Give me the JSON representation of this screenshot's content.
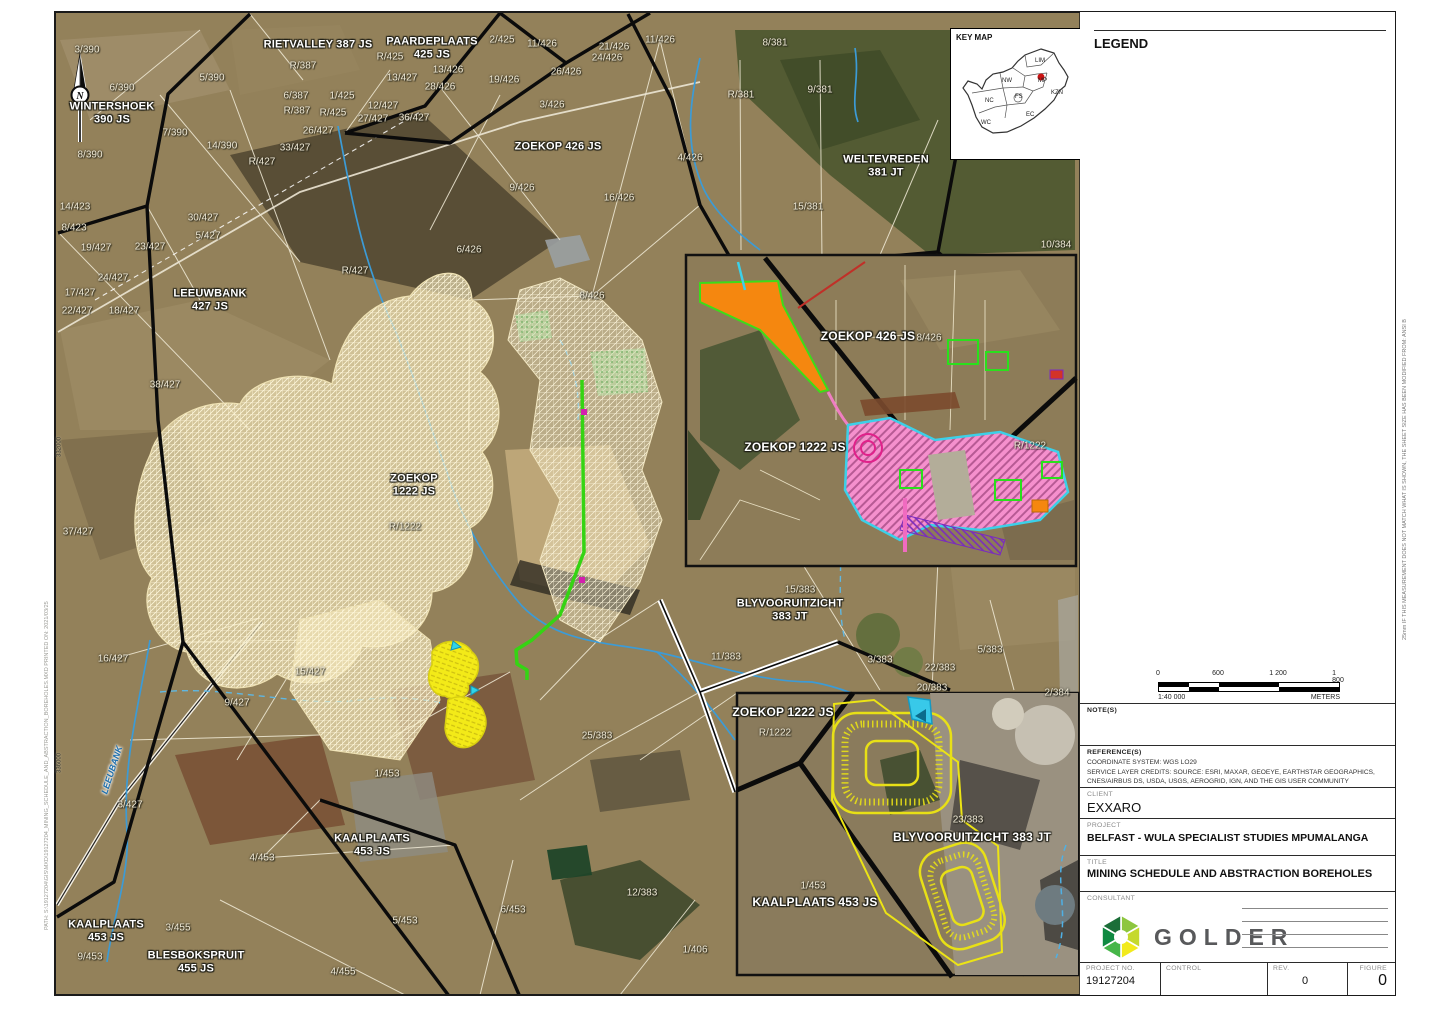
{
  "key_map": {
    "title": "KEY MAP",
    "provinces": [
      {
        "t": "LIM",
        "x": 80,
        "y": 19
      },
      {
        "t": "NW",
        "x": 47,
        "y": 39
      },
      {
        "t": "MP",
        "x": 83,
        "y": 39
      },
      {
        "t": "FS",
        "x": 60,
        "y": 55
      },
      {
        "t": "KZN",
        "x": 96,
        "y": 51
      },
      {
        "t": "NC",
        "x": 30,
        "y": 59
      },
      {
        "t": "EC",
        "x": 71,
        "y": 73
      },
      {
        "t": "WC",
        "x": 26,
        "y": 81
      }
    ],
    "marker_color": "#cc1111"
  },
  "legend": {
    "title": "LEGEND",
    "items": [
      {
        "label": "Conveyor Alternative D PCD's",
        "type": "line",
        "color": "#c4259f"
      },
      {
        "label": "Conveyor Alternative D",
        "type": "line",
        "color": "#76c043"
      },
      {
        "label": "Sumps",
        "type": "line-thin",
        "color": "#7fd4e4"
      },
      {
        "label": "BEP 2020 Infrastructure Area",
        "type": "fill",
        "color": "#f4f3ee",
        "border": "#e3e1d8"
      },
      {
        "label": "Discard Dump (Pit 5b)",
        "type": "line-thin",
        "color": "#efe9a0"
      },
      {
        "label": "BIP Opencast Schedule",
        "type": "fill",
        "color": "#fbf3d3",
        "border": "#e8dfba"
      },
      {
        "label": "BEP Opencast Schedule",
        "type": "fill",
        "color": "#fdf9e7",
        "border": "#ebe6cc"
      },
      {
        "label": "Parent Farms",
        "type": "rect-thick",
        "color": "#000000"
      },
      {
        "label": "Farm Portions",
        "type": "rect-thin",
        "color": "#cfcdc2"
      },
      {
        "label": "MiningRightsArea",
        "type": "rect-double",
        "color": "#000000"
      },
      {
        "label": "River perennial",
        "type": "line-thin",
        "color": "#2e9fd4"
      },
      {
        "label": "River non perennial",
        "type": "line-thin",
        "color": "#6cbde4"
      }
    ]
  },
  "scalebar": {
    "ticks": [
      "0",
      "600",
      "1 200",
      "1 800"
    ],
    "ratio": "1:40 000",
    "units": "METERS"
  },
  "titleblock": {
    "notes_label": "NOTE(S)",
    "references_label": "REFERENCE(S)",
    "reference_lines": [
      "COORDINATE SYSTEM: WGS LO29",
      "SERVICE LAYER CREDITS: SOURCE: ESRI, MAXAR, GEOEYE, EARTHSTAR GEOGRAPHICS,",
      "CNES/AIRBUS DS, USDA, USGS, AEROGRID, IGN, AND THE GIS USER COMMUNITY"
    ],
    "client_label": "CLIENT",
    "client": "EXXARO",
    "project_label": "PROJECT",
    "project": "BELFAST - WULA SPECIALIST STUDIES MPUMALANGA",
    "title_label": "TITLE",
    "title": "MINING SCHEDULE AND ABSTRACTION BOREHOLES",
    "consultant_label": "CONSULTANT",
    "consultant_logo": "GOLDER",
    "rows": [
      {
        "label": "YYYY-MM-DD",
        "value": "2021/03/25"
      },
      {
        "label": "DESIGNED",
        "value": "MB"
      },
      {
        "label": "PREPARED",
        "value": "MJ"
      },
      {
        "label": "REVIEWED",
        "value": "DM"
      },
      {
        "label": "APPROVED",
        "value": "DM"
      }
    ],
    "project_no_label": "PROJECT NO.",
    "project_no": "19127204",
    "control_label": "CONTROL",
    "control": "",
    "rev_label": "REV.",
    "rev": "0",
    "figure_label": "FIGURE",
    "figure": "0",
    "sheet_note": "25mm   IF THIS MEASUREMENT DOES NOT MATCH WHAT IS SHOWN, THE SHEET SIZE HAS BEEN MODIFIED FROM: ANSI B",
    "path_note": "PATH: S:\\19127204\\GIS\\MXD\\19127204_MINING_SCHEDULE_AND_ABSTRACTION_BOREHOLES.MXD   PRINTED ON: 2021/03/25"
  },
  "map": {
    "farm_labels": [
      [
        "WINTERSHOEK\n390 JS",
        112,
        113
      ],
      [
        "RIETVALLEY 387 JS",
        318,
        45
      ],
      [
        "PAARDEPLAATS\n425 JS",
        432,
        48
      ],
      [
        "ZOEKOP 426 JS",
        558,
        147
      ],
      [
        "WELTEVREDEN\n381 JT",
        886,
        166
      ],
      [
        "LEEUWBANK\n427 JS",
        210,
        300
      ],
      [
        "ZOEKOP\n1222 JS",
        414,
        485
      ],
      [
        "BLYVOORUITZICHT\n383 JT",
        790,
        610
      ],
      [
        "KAALPLAATS\n453 JS",
        372,
        845
      ],
      [
        "KAALPLAATS\n453 JS",
        106,
        931
      ],
      [
        "BLESBOKSPRUIT\n455 JS",
        196,
        962
      ]
    ],
    "inset_farm_labels": [
      [
        "ZOEKOP 426 JS",
        868,
        337
      ],
      [
        "ZOEKOP 1222 JS",
        795,
        448
      ],
      [
        "ZOEKOP 1222 JS",
        783,
        713
      ],
      [
        "BLYVOORUITZICHT 383 JT",
        972,
        838
      ],
      [
        "KAALPLAATS 453 JS",
        815,
        903
      ]
    ],
    "portion_labels": [
      [
        "3/390",
        87,
        50
      ],
      [
        "6/390",
        122,
        88
      ],
      [
        "5/390",
        212,
        78
      ],
      [
        "8/390",
        90,
        155
      ],
      [
        "7/390",
        175,
        133
      ],
      [
        "14/390",
        222,
        146
      ],
      [
        "R/387",
        303,
        66
      ],
      [
        "6/387",
        296,
        96
      ],
      [
        "R/387",
        297,
        111
      ],
      [
        "R/425",
        390,
        57
      ],
      [
        "R/425",
        333,
        113
      ],
      [
        "1/425",
        342,
        96
      ],
      [
        "13/427",
        402,
        78
      ],
      [
        "12/427",
        383,
        106
      ],
      [
        "26/427",
        318,
        131
      ],
      [
        "27/427",
        373,
        119
      ],
      [
        "36/427",
        414,
        118
      ],
      [
        "33/427",
        295,
        148
      ],
      [
        "R/427",
        262,
        162
      ],
      [
        "R/427",
        355,
        271
      ],
      [
        "14/423",
        75,
        207
      ],
      [
        "8/423",
        74,
        228
      ],
      [
        "19/427",
        96,
        248
      ],
      [
        "23/427",
        150,
        247
      ],
      [
        "30/427",
        203,
        218
      ],
      [
        "5/427",
        208,
        236
      ],
      [
        "24/427",
        113,
        278
      ],
      [
        "17/427",
        80,
        293
      ],
      [
        "22/427",
        77,
        311
      ],
      [
        "18/427",
        124,
        311
      ],
      [
        "38/427",
        165,
        385
      ],
      [
        "37/427",
        78,
        532
      ],
      [
        "16/427",
        113,
        659
      ],
      [
        "15/427",
        310,
        672
      ],
      [
        "9/427",
        237,
        703
      ],
      [
        "3/427",
        130,
        805
      ],
      [
        "2/425",
        502,
        40
      ],
      [
        "11/426",
        542,
        44
      ],
      [
        "21/426",
        614,
        47
      ],
      [
        "11/426",
        660,
        40
      ],
      [
        "24/426",
        607,
        58
      ],
      [
        "13/426",
        448,
        70
      ],
      [
        "26/426",
        566,
        72
      ],
      [
        "19/426",
        504,
        80
      ],
      [
        "28/426",
        440,
        87
      ],
      [
        "3/426",
        552,
        105
      ],
      [
        "4/426",
        690,
        158
      ],
      [
        "9/426",
        522,
        188
      ],
      [
        "16/426",
        619,
        198
      ],
      [
        "6/426",
        469,
        250
      ],
      [
        "8/426",
        592,
        296
      ],
      [
        "8/381",
        775,
        43
      ],
      [
        "R/381",
        741,
        95
      ],
      [
        "9/381",
        820,
        90
      ],
      [
        "15/381",
        808,
        207
      ],
      [
        "10/384",
        1056,
        245
      ],
      [
        "R/1222",
        405,
        527
      ],
      [
        "15/383",
        800,
        590
      ],
      [
        "11/383",
        726,
        657
      ],
      [
        "3/383",
        880,
        660
      ],
      [
        "22/383",
        940,
        668
      ],
      [
        "5/383",
        990,
        650
      ],
      [
        "20/383",
        932,
        688
      ],
      [
        "25/383",
        597,
        736
      ],
      [
        "2/384",
        1057,
        693
      ],
      [
        "1/453",
        387,
        774
      ],
      [
        "4/453",
        262,
        858
      ],
      [
        "3/455",
        178,
        928
      ],
      [
        "5/453",
        405,
        921
      ],
      [
        "9/453",
        90,
        957
      ],
      [
        "6/453",
        513,
        910
      ],
      [
        "12/383",
        642,
        893
      ],
      [
        "1/406",
        695,
        950
      ],
      [
        "4/455",
        343,
        972
      ],
      [
        "8/426",
        929,
        338
      ],
      [
        "R/1222",
        1030,
        446
      ],
      [
        "R/1222",
        775,
        733
      ],
      [
        "23/383",
        968,
        820
      ],
      [
        "1/453",
        813,
        886
      ]
    ],
    "river_label": {
      "t": "LEEUBANK",
      "x": 112,
      "y": 770,
      "rot": -72
    },
    "coord_labels": [
      {
        "t": "332000",
        "x": 60,
        "y": 447,
        "rot": -90
      },
      {
        "t": "336000",
        "x": 60,
        "y": 763,
        "rot": -90
      }
    ]
  }
}
